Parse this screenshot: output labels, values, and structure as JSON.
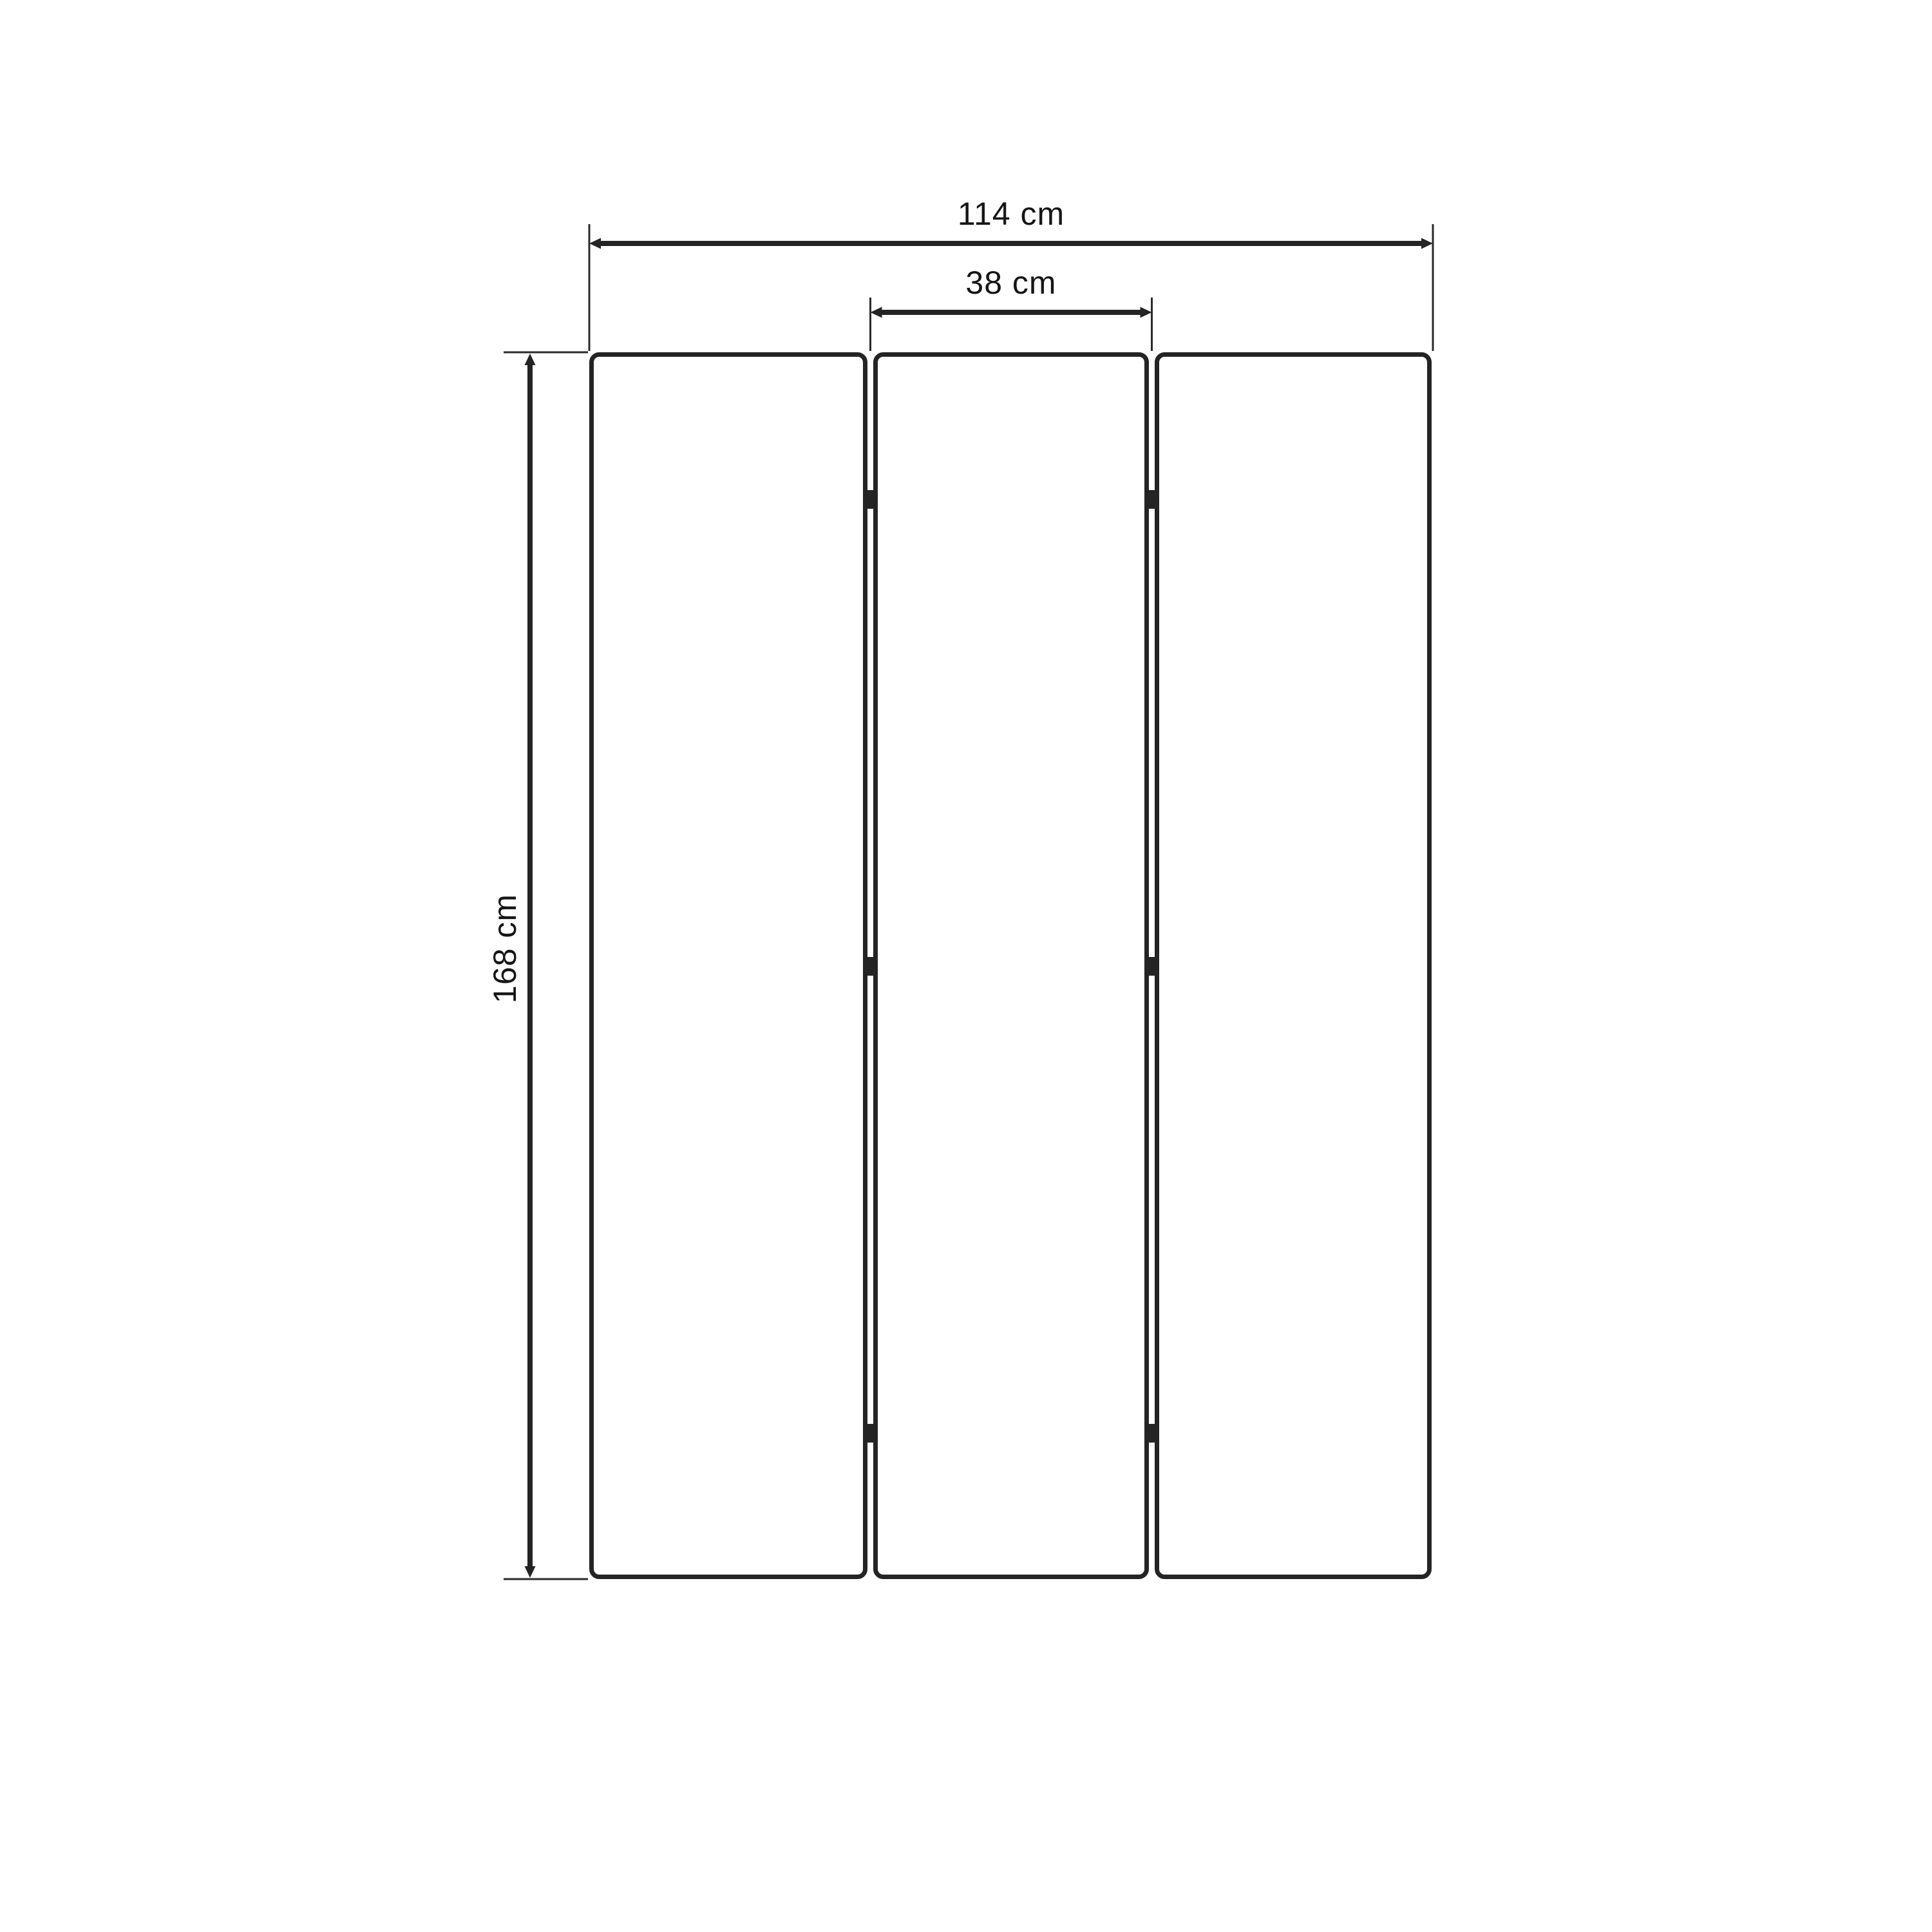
{
  "drawing": {
    "background": "#ffffff",
    "stroke_color": "#242424",
    "label_color": "#161616",
    "panel_count": 3,
    "hinge_marks_per_gap": 3,
    "dimensions": {
      "overall_width": {
        "label": "114 cm",
        "value": 114,
        "unit": "cm"
      },
      "panel_width": {
        "label": "38 cm",
        "value": 38,
        "unit": "cm"
      },
      "overall_height": {
        "label": "168 cm",
        "value": 168,
        "unit": "cm"
      }
    }
  }
}
